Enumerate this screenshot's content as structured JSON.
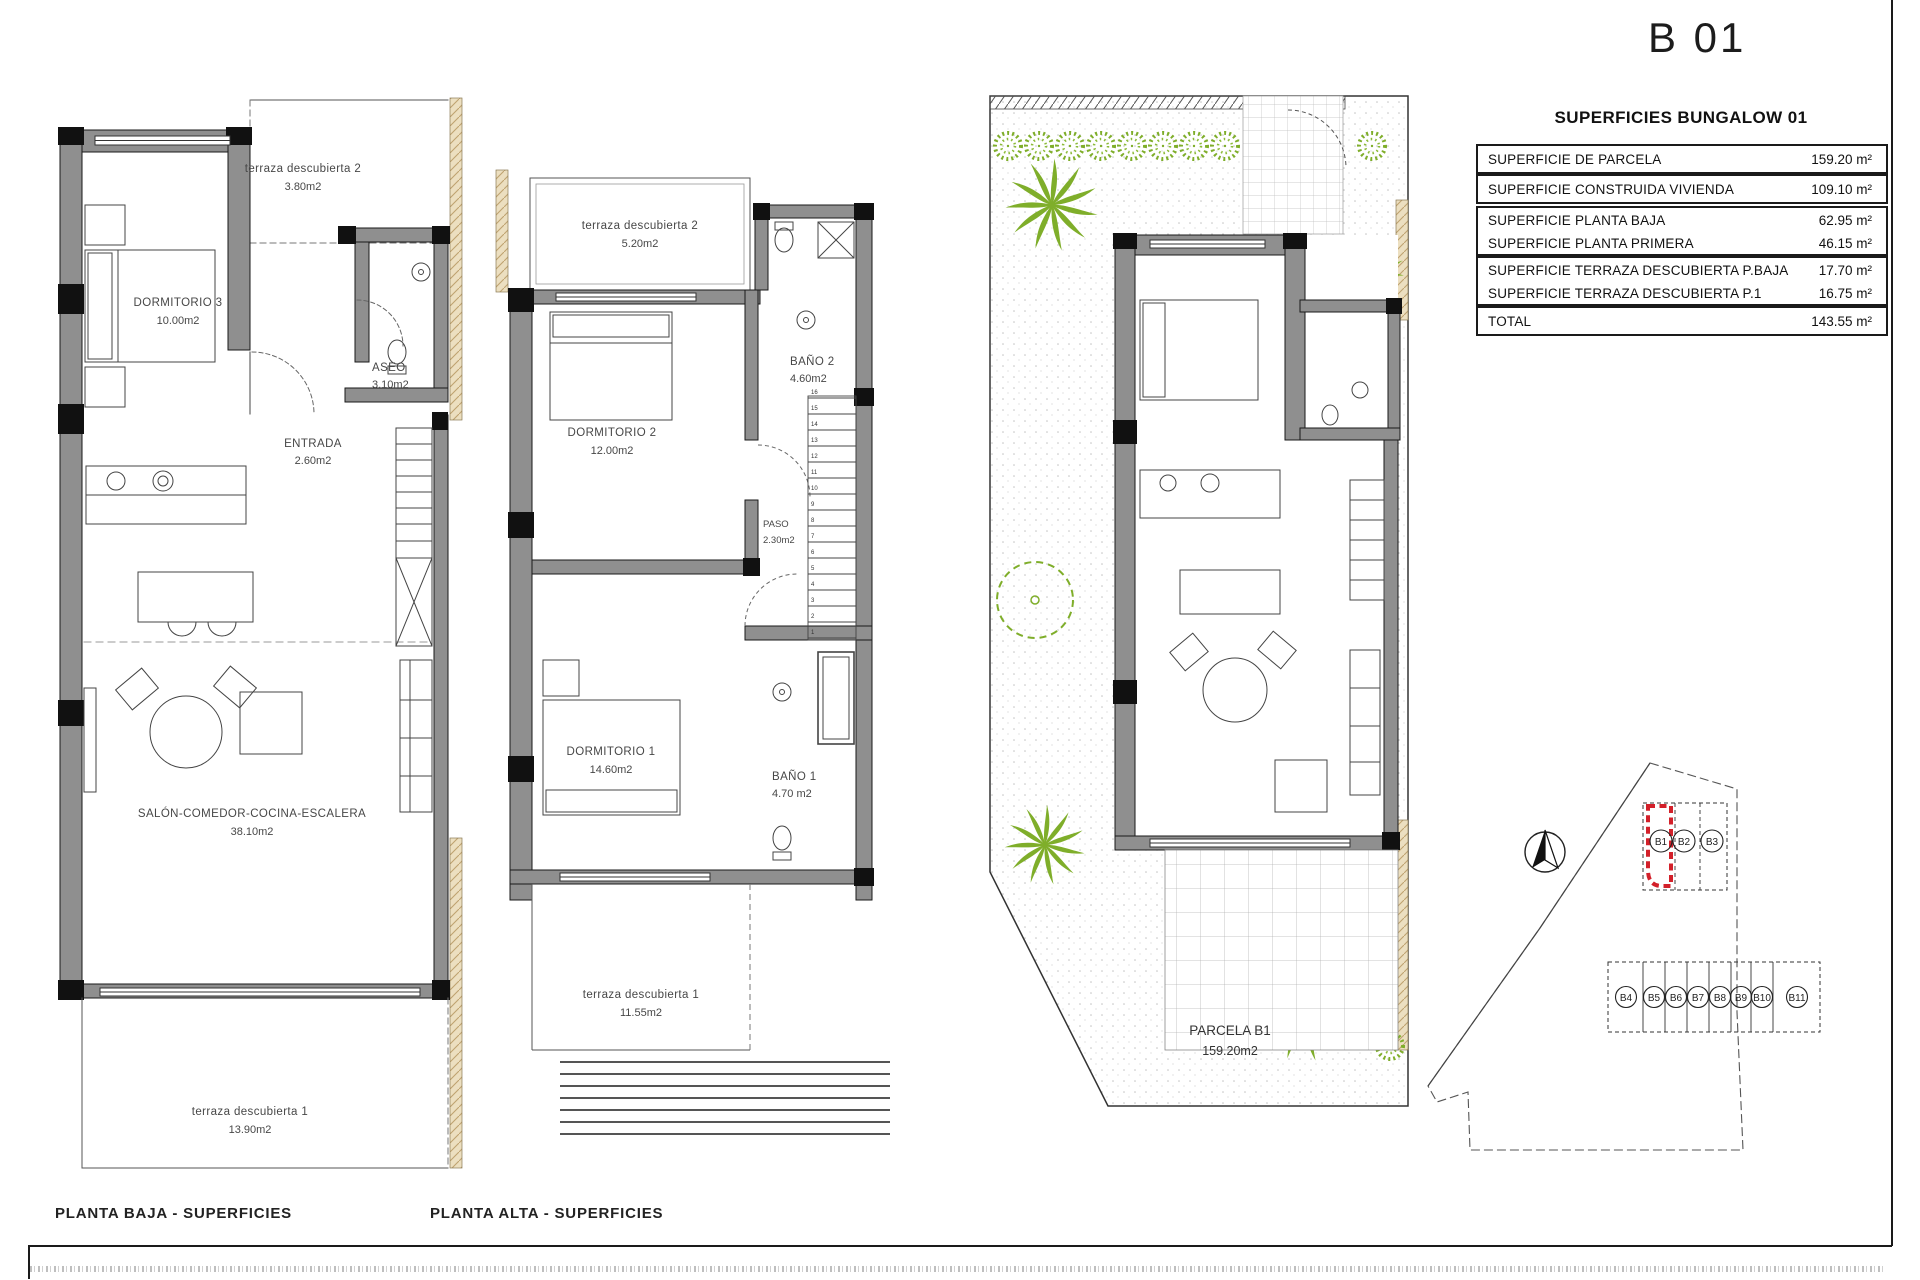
{
  "sheet": {
    "code": "B 01"
  },
  "summary_table": {
    "title": "SUPERFICIES BUNGALOW 01",
    "rows": [
      {
        "label": "SUPERFICIE DE PARCELA",
        "value": "159.20 m²"
      },
      {
        "label": "SUPERFICIE CONSTRUIDA VIVIENDA",
        "value": "109.10 m²"
      },
      {
        "label": "SUPERFICIE PLANTA BAJA",
        "value": "62.95 m²"
      },
      {
        "label": "SUPERFICIE PLANTA PRIMERA",
        "value": "46.15 m²"
      },
      {
        "label": "SUPERFICIE TERRAZA DESCUBIERTA P.BAJA",
        "value": "17.70 m²"
      },
      {
        "label": "SUPERFICIE TERRAZA DESCUBIERTA P.1",
        "value": "16.75 m²"
      },
      {
        "label": "TOTAL",
        "value": "143.55 m²"
      }
    ]
  },
  "plans": {
    "baja": {
      "caption": "PLANTA BAJA - SUPERFICIES",
      "terraza2": {
        "name": "terraza descubierta 2",
        "area": "3.80m2"
      },
      "dormitorio3": {
        "name": "DORMITORIO 3",
        "area": "10.00m2"
      },
      "aseo": {
        "name": "ASEO",
        "area": "3.10m2"
      },
      "entrada": {
        "name": "ENTRADA",
        "area": "2.60m2"
      },
      "salon": {
        "name": "SALÓN-COMEDOR-COCINA-ESCALERA",
        "area": "38.10m2"
      },
      "terraza1": {
        "name": "terraza descubierta 1",
        "area": "13.90m2"
      }
    },
    "alta": {
      "caption": "PLANTA ALTA - SUPERFICIES",
      "terraza2": {
        "name": "terraza descubierta 2",
        "area": "5.20m2"
      },
      "dormitorio2": {
        "name": "DORMITORIO 2",
        "area": "12.00m2"
      },
      "bano2": {
        "name": "BAÑO 2",
        "area": "4.60m2"
      },
      "paso": {
        "name": "PASO",
        "area": "2.30m2"
      },
      "dormitorio1": {
        "name": "DORMITORIO 1",
        "area": "14.60m2"
      },
      "bano1": {
        "name": "BAÑO 1",
        "area": "4.70 m2"
      },
      "terraza1": {
        "name": "terraza descubierta 1",
        "area": "11.55m2"
      },
      "stairs": {
        "count": 16
      }
    },
    "parcela": {
      "label": "PARCELA B1",
      "area": "159.20m2"
    }
  },
  "site_map": {
    "top_row": [
      "B1",
      "B2",
      "B3"
    ],
    "bottom_row": [
      "B4",
      "B5",
      "B6",
      "B7",
      "B8",
      "B9",
      "B10",
      "B11"
    ]
  },
  "colors": {
    "highlight_red": "#d3202a",
    "plant_green": "#7fae2a",
    "wall_gray": "#8f8f8f",
    "hatch_tan": "#ecdfc0"
  }
}
